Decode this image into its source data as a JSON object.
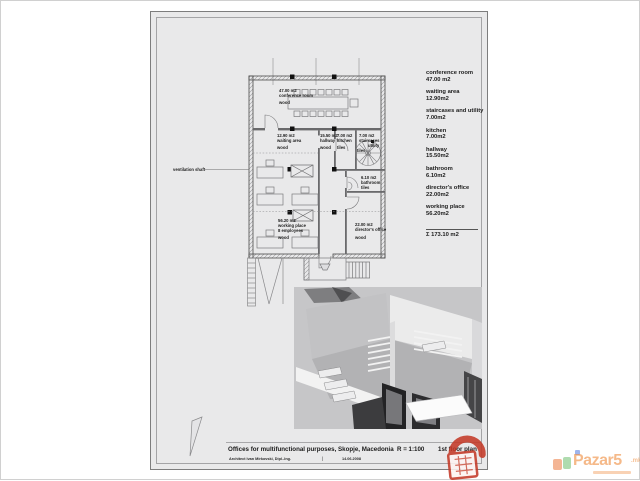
{
  "colors": {
    "paper": "#e9e9ea",
    "wall_line": "#4a4a4a",
    "brand_orange": "#ee8a3a",
    "lock_red": "#c43a28"
  },
  "legend": {
    "items": [
      {
        "name": "conference room",
        "area": "47.00 m2"
      },
      {
        "name": "waiting area",
        "area": "12.90m2"
      },
      {
        "name": "staircases and utility",
        "area": "7.00m2"
      },
      {
        "name": "kitchen",
        "area": "7.00m2"
      },
      {
        "name": "hallway",
        "area": "15.50m2"
      },
      {
        "name": "bathroom",
        "area": "6.10m2"
      },
      {
        "name": "director's office",
        "area": "22.00m2"
      },
      {
        "name": "working place",
        "area": "56.20m2"
      }
    ],
    "total": "Σ 173.10 m2"
  },
  "plan": {
    "rooms": {
      "conference": {
        "area": "47.00 m2",
        "name": "conference room",
        "floor": "wood"
      },
      "waiting": {
        "area": "12.90 m2",
        "name": "waiting area",
        "floor": "wood"
      },
      "hallway": {
        "area": "15.50 m2",
        "name": "hallway",
        "floor": "wood"
      },
      "kitchen": {
        "area": "7.00 m2",
        "name": "kitchen",
        "floor": "tiles"
      },
      "staircases": {
        "area": "7.00 m2",
        "name": "staircases",
        "name2": "utility",
        "floor": "tiles"
      },
      "bathroom": {
        "area": "6.10 m2",
        "name": "bathroom",
        "floor": "tiles"
      },
      "director": {
        "area": "22.00 m2",
        "name": "director's office",
        "floor": "wood"
      },
      "working": {
        "area": "56.20 m2",
        "name": "working place",
        "name2": "8 employees",
        "floor": "wood"
      }
    },
    "annotations": {
      "ventilation_shaft": "ventilation shaft"
    }
  },
  "titleblock": {
    "project": "Offices for multifunctional purposes, Skopje, Macedonia",
    "scale": "R = 1:100",
    "sheet_name": "1st floor plan",
    "architect": "Architect Ivan Mirkovski, Dipl.-Ing.",
    "date": "14.06.2008"
  },
  "watermark": {
    "brand": "Pazar5",
    "suffix": ".mk"
  }
}
